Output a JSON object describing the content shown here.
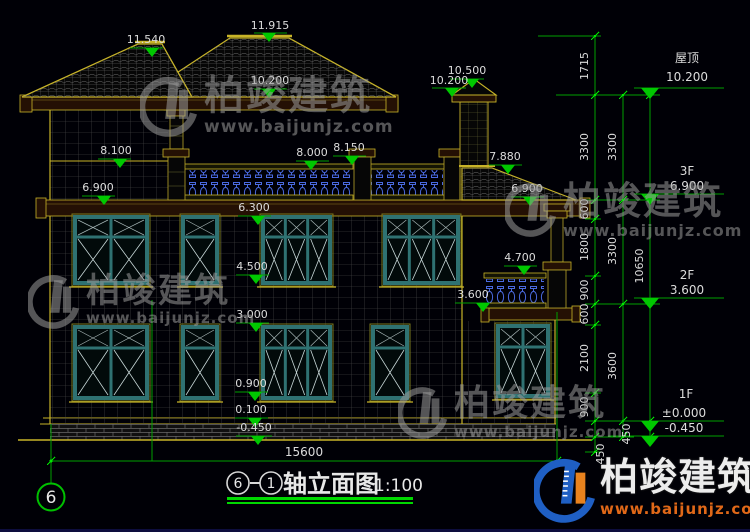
{
  "colors": {
    "background": "#000006",
    "outline_yellow": "#c8b428",
    "fascia_brown": "#241004",
    "window_teal": "#2f7272",
    "baluster_blue": "#4a6ae0",
    "dim_green": "#00a000",
    "tick_green": "#00e800",
    "triangle_green": "#00c800",
    "text_white": "#dcdcdc",
    "title_underline_green": "#00d800",
    "logo_blue": "#1f5fc4",
    "logo_orange": "#e8821e"
  },
  "watermark": {
    "brand": "柏竣建筑",
    "url": "www.baijunjz.com"
  },
  "logo": {
    "brand": "柏竣建筑",
    "url": "www.baijunjz.com"
  },
  "title": {
    "axis_from": "6",
    "axis_to": "1",
    "text": "轴立面图",
    "scale": "1:100"
  },
  "axis_bubble": {
    "label": "6"
  },
  "bottom_dimension": {
    "value": "15600"
  },
  "elevation_markers": [
    {
      "text": "11.540",
      "x": 146,
      "y": 43,
      "lx1": 130,
      "lx2": 163,
      "ly": 48,
      "tx": 152
    },
    {
      "text": "11.915",
      "x": 270,
      "y": 29,
      "lx1": 254,
      "lx2": 287,
      "ly": 33,
      "tx": 269
    },
    {
      "text": "10.200",
      "x": 270,
      "y": 84,
      "lx1": 254,
      "lx2": 287,
      "ly": 89,
      "tx": 269
    },
    {
      "text": "8.100",
      "x": 116,
      "y": 154,
      "lx1": 98,
      "lx2": 131,
      "ly": 159,
      "tx": 120
    },
    {
      "text": "8.000",
      "x": 312,
      "y": 156,
      "lx1": 296,
      "lx2": 329,
      "ly": 161,
      "tx": 311
    },
    {
      "text": "8.150",
      "x": 349,
      "y": 151,
      "lx1": 333,
      "lx2": 366,
      "ly": 156,
      "tx": 352
    },
    {
      "text": "6.900",
      "x": 98,
      "y": 191,
      "lx1": 82,
      "lx2": 115,
      "ly": 196,
      "tx": 104
    },
    {
      "text": "6.300",
      "x": 254,
      "y": 211,
      "lx1": 238,
      "lx2": 271,
      "ly": 216,
      "tx": 258
    },
    {
      "text": "4.500",
      "x": 252,
      "y": 270,
      "lx1": 236,
      "lx2": 269,
      "ly": 275,
      "tx": 256
    },
    {
      "text": "3.000",
      "x": 252,
      "y": 318,
      "lx1": 236,
      "lx2": 269,
      "ly": 323,
      "tx": 256
    },
    {
      "text": "0.900",
      "x": 251,
      "y": 387,
      "lx1": 235,
      "lx2": 268,
      "ly": 392,
      "tx": 255
    },
    {
      "text": "0.100",
      "x": 251,
      "y": 413,
      "lx1": 235,
      "lx2": 268,
      "ly": 418,
      "tx": 255
    },
    {
      "text": "-0.450",
      "x": 254,
      "y": 431,
      "lx1": 236,
      "lx2": 272,
      "ly": 436,
      "tx": 258
    },
    {
      "text": "10.500",
      "x": 467,
      "y": 74,
      "lx1": 450,
      "lx2": 484,
      "ly": 79,
      "tx": 472
    },
    {
      "text": "10.200",
      "x": 449,
      "y": 84,
      "lx1": 432,
      "lx2": 466,
      "ly": 88,
      "tx": 452
    },
    {
      "text": "7.880",
      "x": 505,
      "y": 160,
      "lx1": 489,
      "lx2": 522,
      "ly": 165,
      "tx": 508
    },
    {
      "text": "6.900",
      "x": 527,
      "y": 192,
      "lx1": 511,
      "lx2": 544,
      "ly": 197,
      "tx": 530
    },
    {
      "text": "4.700",
      "x": 520,
      "y": 261,
      "lx1": 504,
      "lx2": 537,
      "ly": 266,
      "tx": 524
    },
    {
      "text": "3.600",
      "x": 473,
      "y": 298,
      "lx1": 455,
      "lx2": 490,
      "ly": 303,
      "tx": 483
    }
  ],
  "floor_levels": [
    {
      "label": "屋顶",
      "value": "10.200",
      "label_x": 687,
      "label_y": 62,
      "value_x": 687,
      "value_y": 81,
      "ly": 88,
      "lx1": 634,
      "lx2": 724,
      "tip_y": 99
    },
    {
      "label": "3F",
      "value": "6.900",
      "label_x": 687,
      "label_y": 175,
      "value_x": 687,
      "value_y": 190,
      "ly": 194,
      "lx1": 634,
      "lx2": 724,
      "tip_y": 205
    },
    {
      "label": "2F",
      "value": "3.600",
      "label_x": 687,
      "label_y": 279,
      "value_x": 687,
      "value_y": 294,
      "ly": 298,
      "lx1": 634,
      "lx2": 724,
      "tip_y": 309
    },
    {
      "label": "1F",
      "value": "±0.000",
      "label_x": 686,
      "label_y": 398,
      "value_x": 684,
      "value_y": 417,
      "ly": 421,
      "lx1": 608,
      "lx2": 724,
      "tip_y": 432
    },
    {
      "label": "",
      "value": "-0.450",
      "label_x": 686,
      "label_y": 0,
      "value_x": 684,
      "value_y": 432,
      "ly": 436,
      "lx1": 608,
      "lx2": 724,
      "tip_y": 447
    }
  ],
  "dim_chain_labels": [
    {
      "text": "1715",
      "x": 588,
      "y": 66
    },
    {
      "text": "3300",
      "x": 588,
      "y": 147
    },
    {
      "text": "3300",
      "x": 616,
      "y": 147
    },
    {
      "text": "600",
      "x": 588,
      "y": 209
    },
    {
      "text": "1800",
      "x": 588,
      "y": 247
    },
    {
      "text": "3300",
      "x": 616,
      "y": 251
    },
    {
      "text": "10650",
      "x": 643,
      "y": 266
    },
    {
      "text": "900",
      "x": 588,
      "y": 290
    },
    {
      "text": "600",
      "x": 588,
      "y": 314
    },
    {
      "text": "2100",
      "x": 588,
      "y": 358
    },
    {
      "text": "3600",
      "x": 616,
      "y": 366
    },
    {
      "text": "900",
      "x": 588,
      "y": 407
    },
    {
      "text": "450",
      "x": 630,
      "y": 434
    },
    {
      "text": "450",
      "x": 604,
      "y": 454
    }
  ]
}
